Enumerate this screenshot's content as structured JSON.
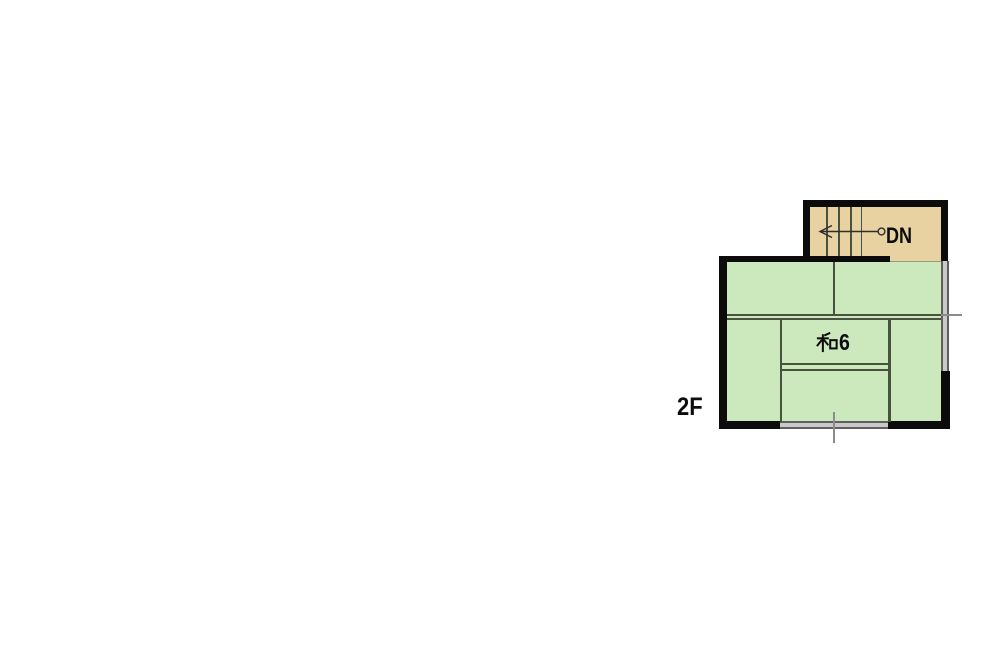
{
  "floor_plan": {
    "floor_label": "2F",
    "stairs": {
      "label": "DN",
      "arrow_direction": "left",
      "tread_count": 4
    },
    "rooms": [
      {
        "label": "和6",
        "label_kanji": "和",
        "label_digit": "6",
        "type": "japanese-style-room-6-mats"
      }
    ],
    "colors": {
      "stairs_fill": "#e9d2a2",
      "room_fill": "#cce9bd",
      "wall": "#0b0b0b",
      "partition_line": "#49513f",
      "window_fill": "#c9c9c9",
      "window_edge": "#5f5f5f",
      "tick_line": "#8c8c8c",
      "text": "#0d0d0d",
      "background": "#ffffff"
    }
  }
}
